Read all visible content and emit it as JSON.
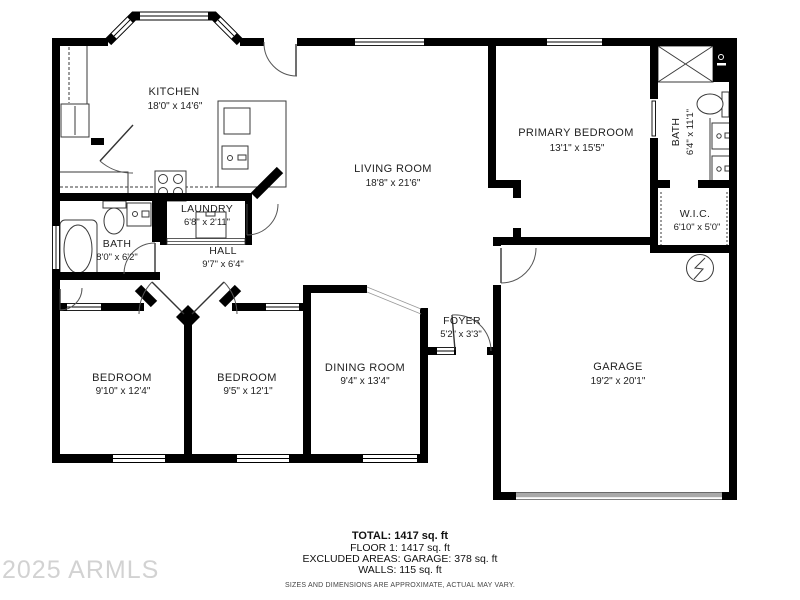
{
  "watermark": "2025 ARMLS",
  "summary": {
    "total": "TOTAL: 1417 sq. ft",
    "floor1": "FLOOR 1: 1417 sq. ft",
    "excluded": "EXCLUDED AREAS: GARAGE: 378 sq. ft",
    "walls": "WALLS: 115 sq. ft",
    "disclaimer": "SIZES AND DIMENSIONS ARE APPROXIMATE, ACTUAL MAY VARY."
  },
  "rooms": {
    "kitchen": {
      "name": "KITCHEN",
      "dims": "18'0\" x 14'6\""
    },
    "living_room": {
      "name": "LIVING ROOM",
      "dims": "18'8\" x 21'6\""
    },
    "primary_bedroom": {
      "name": "PRIMARY BEDROOM",
      "dims": "13'1\" x 15'5\""
    },
    "primary_bath": {
      "name": "BATH",
      "dims": "6'4\" x 11'1\""
    },
    "wic": {
      "name": "W.I.C.",
      "dims": "6'10\" x 5'0\""
    },
    "laundry": {
      "name": "LAUNDRY",
      "dims": "6'8\" x 2'11\""
    },
    "hall": {
      "name": "HALL",
      "dims": "9'7\" x 6'4\""
    },
    "hall_bath": {
      "name": "BATH",
      "dims": "8'0\" x 6'2\""
    },
    "bedroom_1": {
      "name": "BEDROOM",
      "dims": "9'10\" x 12'4\""
    },
    "bedroom_2": {
      "name": "BEDROOM",
      "dims": "9'5\" x 12'1\""
    },
    "dining_room": {
      "name": "DINING ROOM",
      "dims": "9'4\" x 13'4\""
    },
    "foyer": {
      "name": "FOYER",
      "dims": "5'2\" x 3'3\""
    },
    "garage": {
      "name": "GARAGE",
      "dims": "19'2\" x 20'1\""
    }
  }
}
